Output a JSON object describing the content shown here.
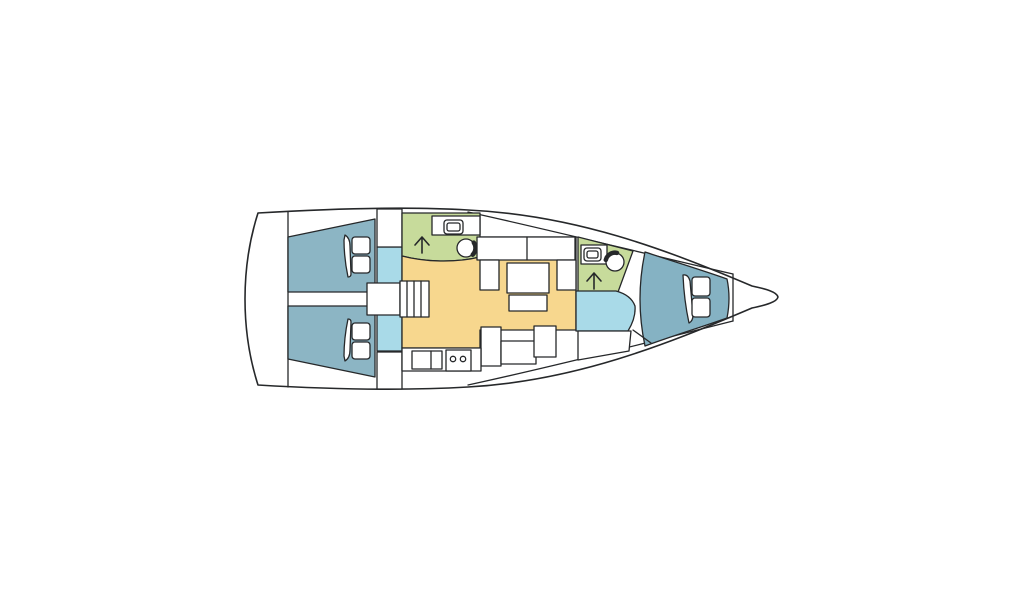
{
  "diagram": {
    "kind": "sailing-yacht-interior-floor-plan",
    "view": "top-down",
    "orientation": "bow-right",
    "background": "#ffffff"
  },
  "colors": {
    "outline": "#26282a",
    "hull": "#ffffff",
    "furniture": "#ffffff",
    "aft_cabin": "#8cb5c4",
    "forward_cabin": "#85b2c3",
    "corridor": "#a9dae8",
    "head": "#c7db9b",
    "saloon": "#f7d78e"
  },
  "rooms": [
    {
      "id": "aft-cabin-port",
      "color_key": "aft_cabin"
    },
    {
      "id": "aft-cabin-starboard",
      "color_key": "aft_cabin"
    },
    {
      "id": "companionway-corridor",
      "color_key": "corridor"
    },
    {
      "id": "aft-head-bathroom",
      "color_key": "head"
    },
    {
      "id": "saloon",
      "color_key": "saloon"
    },
    {
      "id": "galley",
      "color_key": "furniture"
    },
    {
      "id": "forward-head-bathroom",
      "color_key": "head"
    },
    {
      "id": "forward-passage",
      "color_key": "corridor"
    },
    {
      "id": "forward-cabin",
      "color_key": "forward_cabin"
    },
    {
      "id": "anchor-locker",
      "color_key": "hull"
    }
  ],
  "icons": [
    {
      "id": "companionway-stairs-icon",
      "count": 1
    },
    {
      "id": "shower-arrow-icon",
      "count": 2
    },
    {
      "id": "toilet-icon",
      "count": 2
    },
    {
      "id": "washbasin-icon",
      "count": 2
    },
    {
      "id": "galley-sink-icon",
      "count": 1
    },
    {
      "id": "stove-two-burner-icon",
      "count": 1
    },
    {
      "id": "double-berth-icon",
      "count": 3
    },
    {
      "id": "saloon-table-icon",
      "count": 1
    }
  ]
}
